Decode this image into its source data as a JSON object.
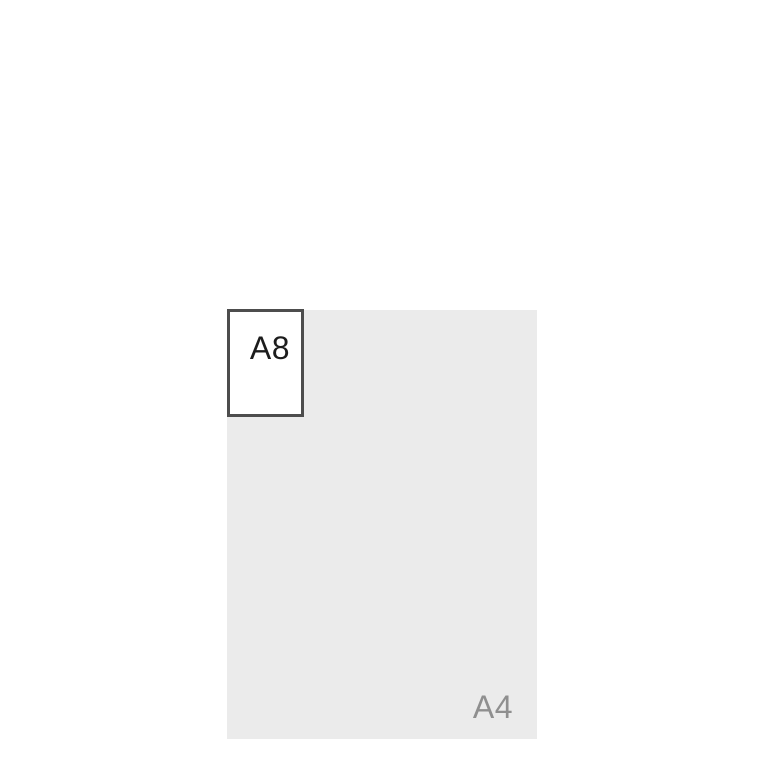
{
  "page": {
    "background": "#ffffff"
  },
  "diagram": {
    "a4_sheet": {
      "label": "A4",
      "fill": "#ebebeb",
      "label_color": "#8f8f8f"
    },
    "a8_sheet": {
      "label": "A8",
      "fill": "#ffffff",
      "border_color": "#4d4d4d",
      "label_color": "#1c1c1c"
    }
  }
}
